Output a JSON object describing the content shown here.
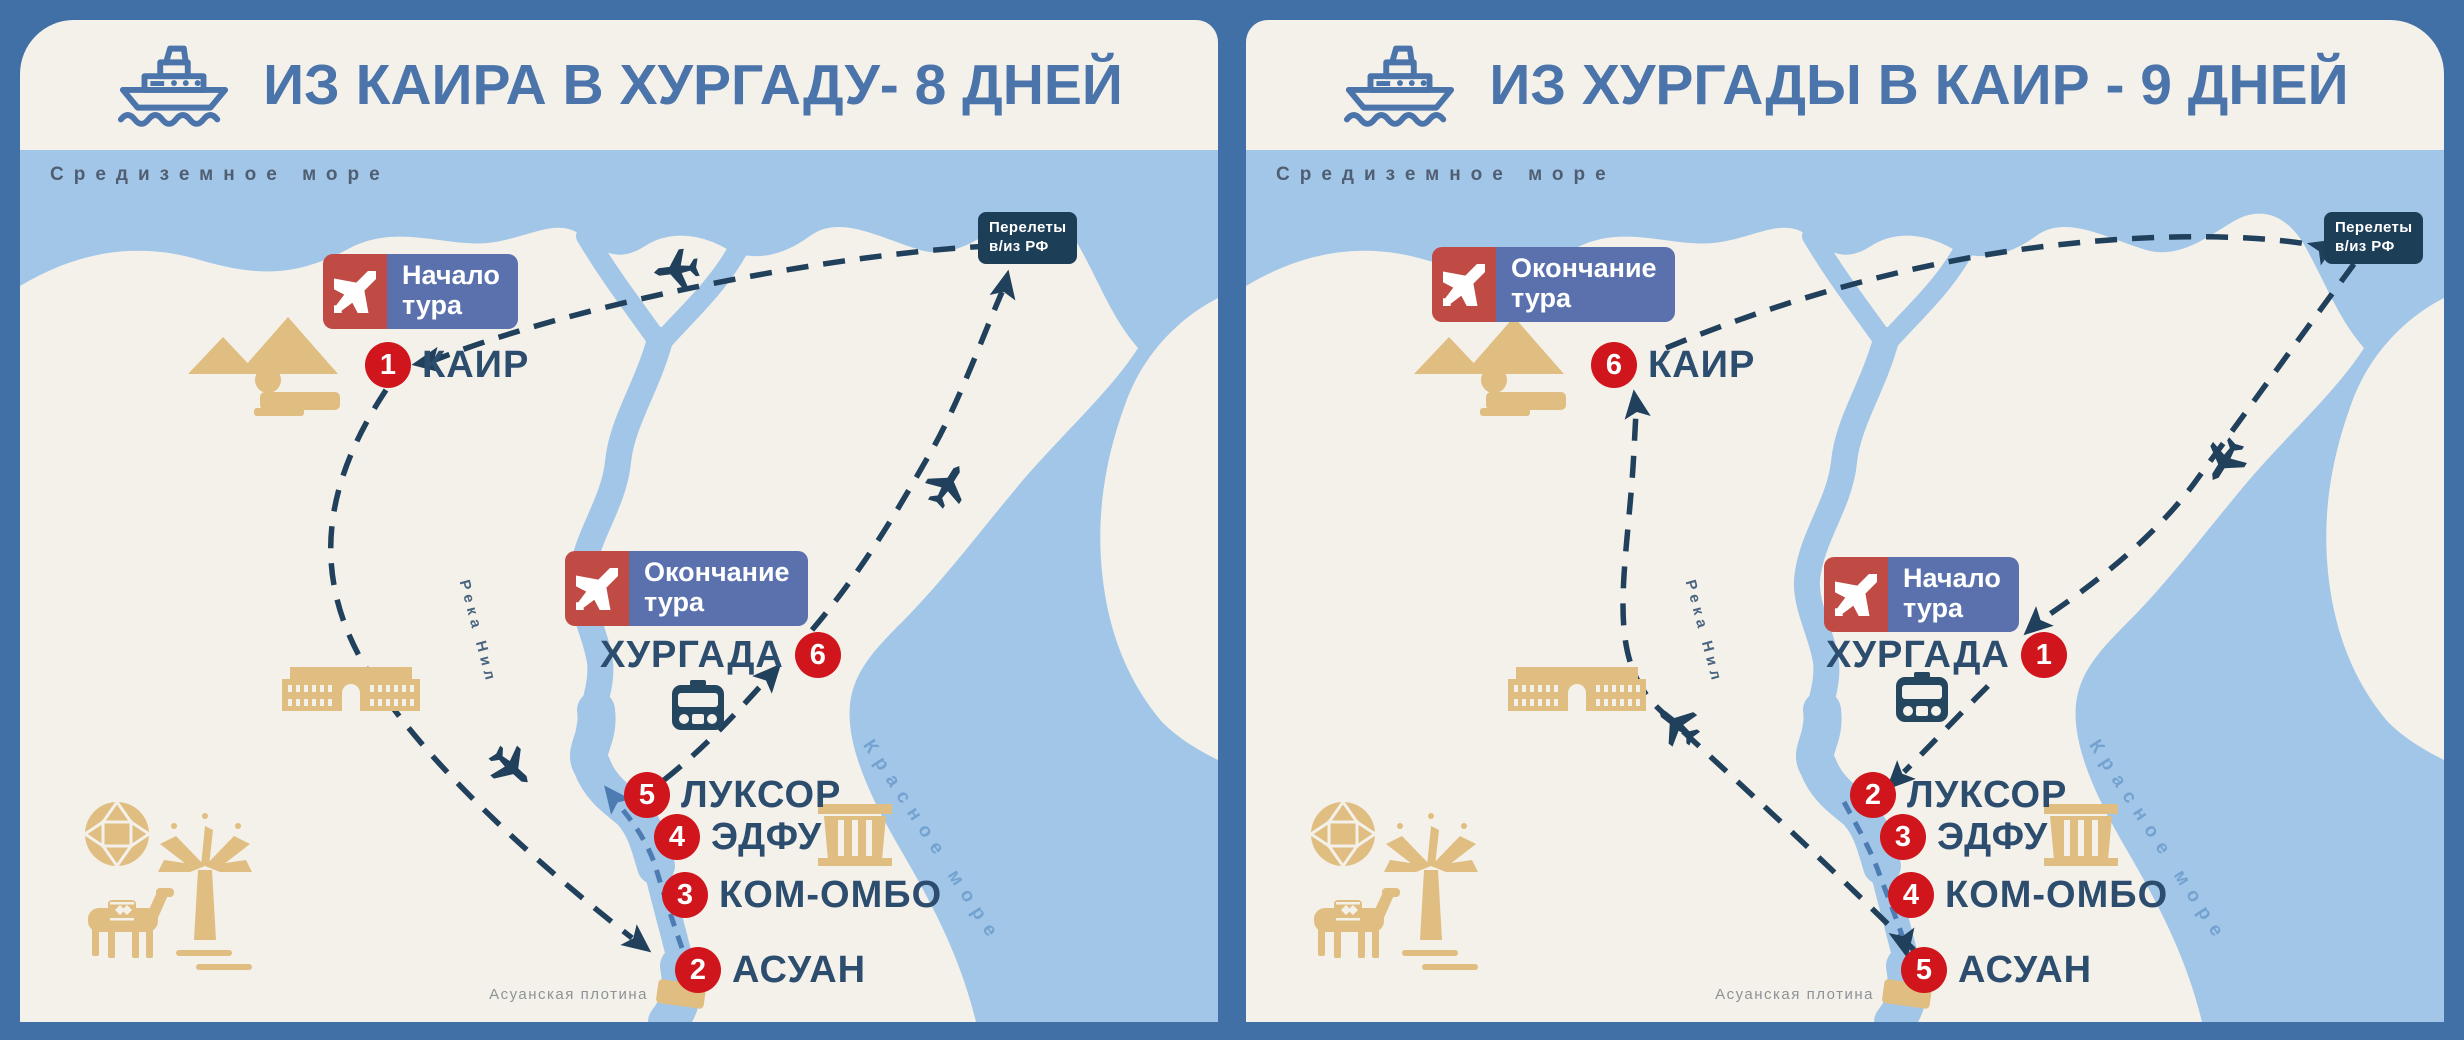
{
  "colors": {
    "background": "#4170a6",
    "card": "#f4f1ea",
    "sea": "#a2c6e8",
    "route_navy": "#20405c",
    "marker_red": "#d0151c",
    "badge_red": "#bf4b44",
    "badge_blue": "#5a71ad",
    "flights_navy": "#1c3e57",
    "sand": "#e0bd80",
    "title_blue": "#4a74aa",
    "cruise_blue": "#4d7cb3"
  },
  "maps": [
    {
      "title": "ИЗ КАИРА В ХУРГАДУ- 8 ДНЕЙ",
      "mediterranean": "Средиземное море",
      "red_sea": "Красное море",
      "river": "Река Нил",
      "dam": "Асуанская плотина",
      "flights": {
        "line1": "Перелеты",
        "line2": "в/из РФ"
      },
      "start_badge": {
        "line1": "Начало",
        "line2": "тура"
      },
      "end_badge": {
        "line1": "Окончание",
        "line2": "тура"
      },
      "cities": {
        "cairo": {
          "num": "1",
          "name": "КАИР"
        },
        "aswan": {
          "num": "2",
          "name": "АСУАН"
        },
        "komombo": {
          "num": "3",
          "name": "КОМ-ОМБО"
        },
        "edfu": {
          "num": "4",
          "name": "ЭДФУ"
        },
        "luxor": {
          "num": "5",
          "name": "ЛУКСОР"
        },
        "hurghada": {
          "num": "6",
          "name": "ХУРГАДА"
        }
      }
    },
    {
      "title": "ИЗ ХУРГАДЫ В КАИР - 9 ДНЕЙ",
      "mediterranean": "Средиземное море",
      "red_sea": "Красное море",
      "river": "Река Нил",
      "dam": "Асуанская плотина",
      "flights": {
        "line1": "Перелеты",
        "line2": "в/из РФ"
      },
      "start_badge": {
        "line1": "Начало",
        "line2": "тура"
      },
      "end_badge": {
        "line1": "Окончание",
        "line2": "тура"
      },
      "cities": {
        "hurghada": {
          "num": "1",
          "name": "ХУРГАДА"
        },
        "luxor": {
          "num": "2",
          "name": "ЛУКСОР"
        },
        "edfu": {
          "num": "3",
          "name": "ЭДФУ"
        },
        "komombo": {
          "num": "4",
          "name": "КОМ-ОМБО"
        },
        "aswan": {
          "num": "5",
          "name": "АСУАН"
        },
        "cairo": {
          "num": "6",
          "name": "КАИР"
        }
      }
    }
  ]
}
